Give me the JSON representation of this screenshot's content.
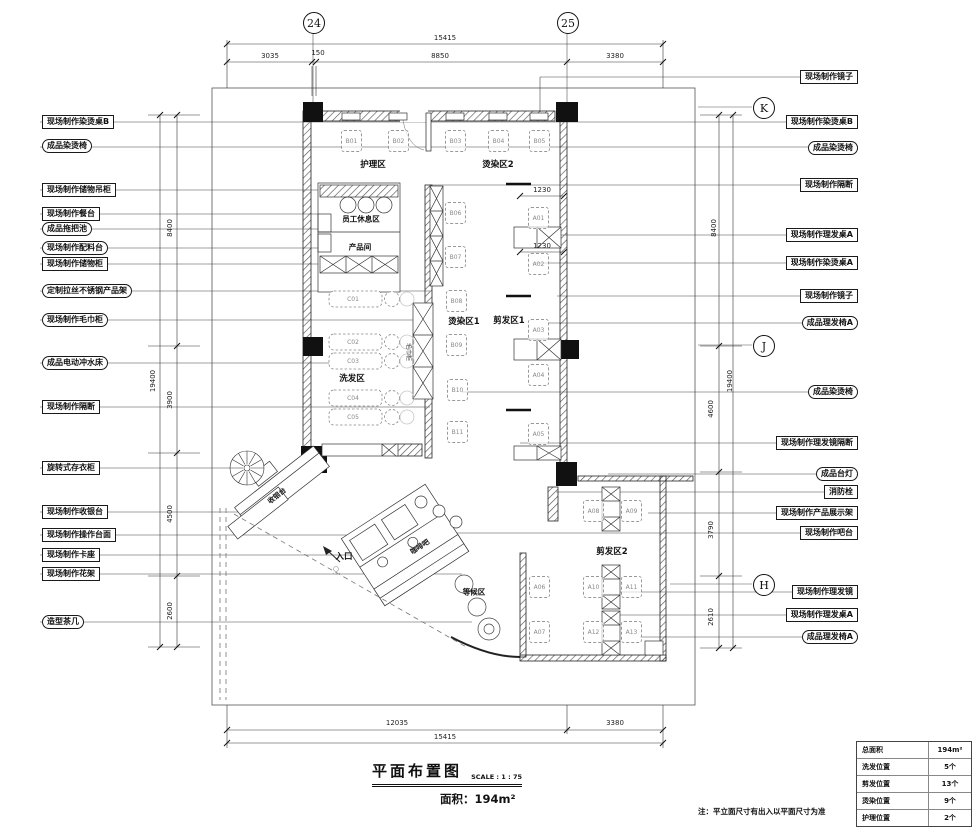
{
  "drawing": {
    "title": "平面布置图",
    "scale": "SCALE : 1 : 75",
    "area": "面积：194m²",
    "note": "注：平立面尺寸有出入以平面尺寸为准"
  },
  "grid": {
    "cols": [
      "24",
      "25"
    ],
    "rows": [
      "K",
      "J",
      "H"
    ]
  },
  "dims": {
    "top": {
      "total": "15415",
      "segs": [
        "3035",
        "150",
        "8850",
        "3380"
      ]
    },
    "bottom": {
      "total": "15415",
      "segs": [
        "12035",
        "3380"
      ]
    },
    "left": {
      "total": "19400",
      "segs": [
        "8400",
        "3900",
        "4500",
        "2600"
      ]
    },
    "right": {
      "total": "19400",
      "segs": [
        "8400",
        "4600",
        "3790",
        "2610"
      ]
    },
    "inner": [
      "1230",
      "1230"
    ]
  },
  "zones": {
    "nursing": "护理区",
    "perm2": "烫染区2",
    "staff": "员工休息区",
    "product": "产品间",
    "wash": "洗发区",
    "perm1": "烫染区1",
    "cut1": "剪发区1",
    "cut2": "剪发区2",
    "cashier": "收银台",
    "entrance": "入口",
    "coffee": "咖啡吧",
    "waiting": "等候区",
    "towel": "毛巾柜"
  },
  "seats": {
    "top": [
      "B01",
      "B02",
      "B03",
      "B04",
      "B05"
    ],
    "column_b": [
      "B06",
      "B07",
      "B08",
      "B09",
      "B10",
      "B11"
    ],
    "column_a": [
      "A01",
      "A02",
      "A03",
      "A04",
      "A05"
    ],
    "wash": [
      "C01",
      "C02",
      "C03",
      "C04",
      "C05"
    ],
    "cut2": [
      "A08",
      "A09",
      "A06",
      "A10",
      "A11",
      "A07",
      "A12",
      "A13"
    ]
  },
  "callouts_left": [
    {
      "label": "现场制作染烫桌B"
    },
    {
      "label": "成品染烫椅"
    },
    {
      "label": "现场制作储物吊柜"
    },
    {
      "label": "现场制作餐台"
    },
    {
      "label": "成品拖把池"
    },
    {
      "label": "现场制作配料台"
    },
    {
      "label": "现场制作储物柜"
    },
    {
      "label": "定制拉丝不锈钢产品架"
    },
    {
      "label": "现场制作毛巾柜"
    },
    {
      "label": "成品电动冲水床"
    },
    {
      "label": "现场制作隔断"
    },
    {
      "label": "旋转式存衣柜"
    },
    {
      "label": "现场制作收银台"
    },
    {
      "label": "现场制作操作台面"
    },
    {
      "label": "现场制作卡座"
    },
    {
      "label": "现场制作花架"
    },
    {
      "label": "造型茶几"
    }
  ],
  "callouts_right": [
    {
      "label": "现场制作镜子"
    },
    {
      "label": "现场制作染烫桌B"
    },
    {
      "label": "成品染烫椅"
    },
    {
      "label": "现场制作隔断"
    },
    {
      "label": "现场制作理发桌A"
    },
    {
      "label": "现场制作染烫桌A"
    },
    {
      "label": "现场制作镜子"
    },
    {
      "label": "成品理发椅A"
    },
    {
      "label": "成品染烫椅"
    },
    {
      "label": "现场制作理发镜隔断"
    },
    {
      "label": "成品台灯"
    },
    {
      "label": "消防栓"
    },
    {
      "label": "现场制作产品展示架"
    },
    {
      "label": "现场制作吧台"
    },
    {
      "label": "现场制作理发镜"
    },
    {
      "label": "现场制作理发桌A"
    },
    {
      "label": "成品理发椅A"
    }
  ],
  "summary": {
    "rows": [
      {
        "k": "总面积",
        "v": "194m²"
      },
      {
        "k": "洗发位置",
        "v": "5个"
      },
      {
        "k": "剪发位置",
        "v": "13个"
      },
      {
        "k": "烫染位置",
        "v": "9个"
      },
      {
        "k": "护理位置",
        "v": "2个"
      }
    ]
  }
}
